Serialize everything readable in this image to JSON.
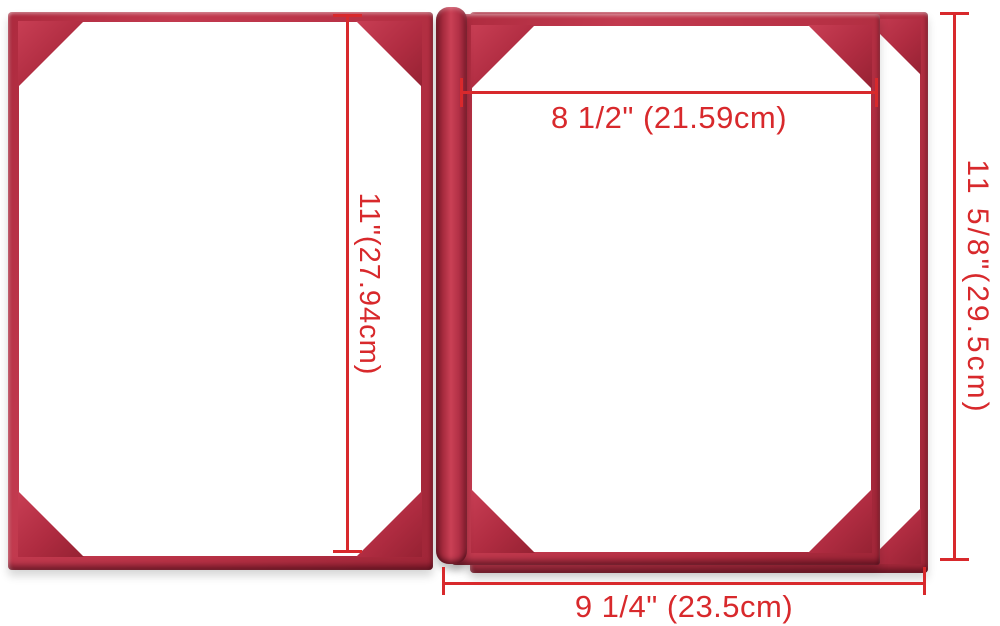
{
  "scene": {
    "description": "Open red leatherette double certificate holder lying flat, annotated with measurements",
    "background_color": "#ffffff"
  },
  "colors": {
    "leather_red": "#b73145",
    "leather_highlight": "#c83e54",
    "leather_dark_edge": "#7c1b2b",
    "page_white": "#ffffff",
    "dimension_red": "#d8292c"
  },
  "dimensions": {
    "top_width_label": "8 1/2\" (21.59cm)",
    "left_height_label": "11\"(27.94cm)",
    "right_height_label": "11 5/8\"(29.5cm)",
    "bottom_width_label": "9 1/4\" (23.5cm)"
  }
}
